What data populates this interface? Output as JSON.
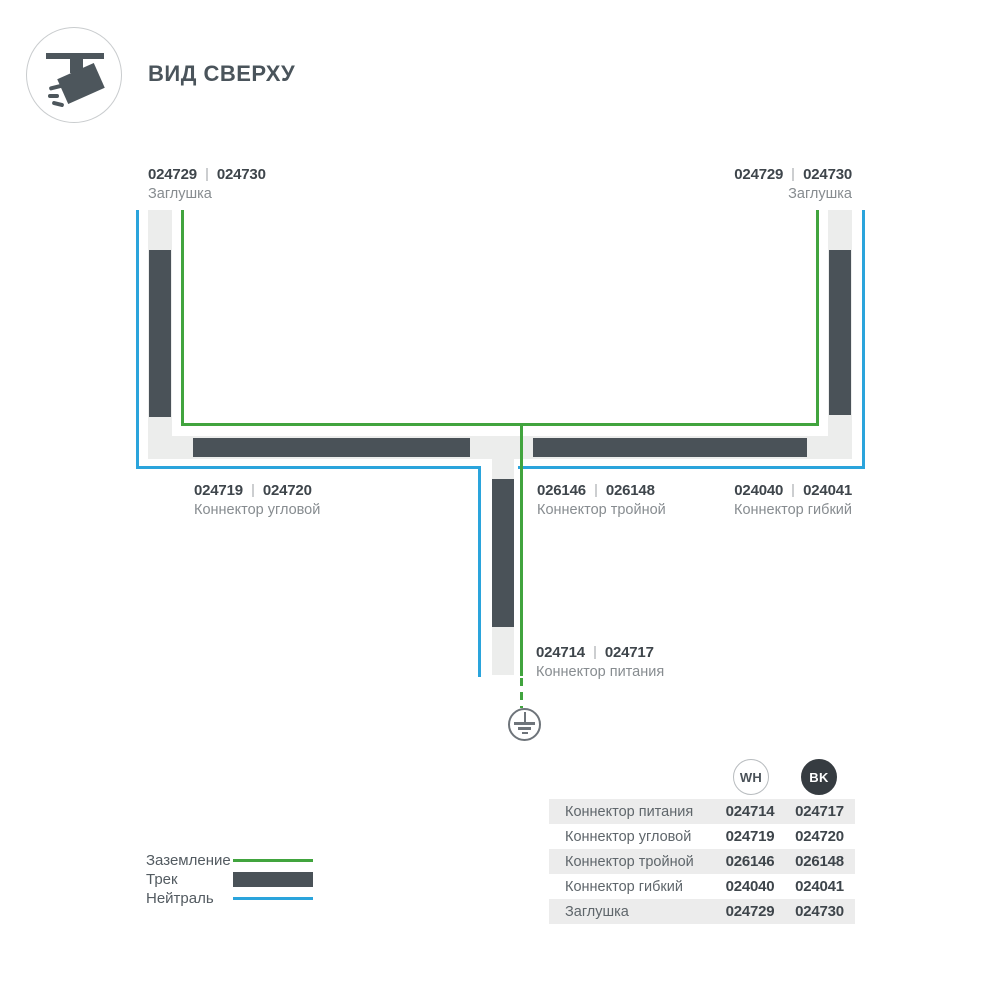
{
  "header": {
    "title": "ВИД СВЕРХУ",
    "icon": "track-spotlight-top-view"
  },
  "colors": {
    "track_bar": "#4a5258",
    "track_body": "#ecedec",
    "ground_line": "#41a43e",
    "neutral_line": "#2aa4dc",
    "bk_badge": "#363c41"
  },
  "labels": {
    "cap_left": {
      "code_wh": "024729",
      "code_bk": "024730",
      "name": "Заглушка"
    },
    "cap_right": {
      "code_wh": "024729",
      "code_bk": "024730",
      "name": "Заглушка"
    },
    "corner": {
      "code_wh": "024719",
      "code_bk": "024720",
      "name": "Коннектор угловой"
    },
    "tee": {
      "code_wh": "026146",
      "code_bk": "026148",
      "name": "Коннектор тройной"
    },
    "flex": {
      "code_wh": "024040",
      "code_bk": "024041",
      "name": "Коннектор гибкий"
    },
    "power": {
      "code_wh": "024714",
      "code_bk": "024717",
      "name": "Коннектор питания"
    }
  },
  "legend": {
    "ground": "Заземление",
    "track": "Трек",
    "neutral": "Нейтраль"
  },
  "table": {
    "columns": {
      "wh": "WH",
      "bk": "BK"
    },
    "rows": [
      {
        "name": "Коннектор питания",
        "wh": "024714",
        "bk": "024717"
      },
      {
        "name": "Коннектор угловой",
        "wh": "024719",
        "bk": "024720"
      },
      {
        "name": "Коннектор тройной",
        "wh": "026146",
        "bk": "026148"
      },
      {
        "name": "Коннектор гибкий",
        "wh": "024040",
        "bk": "024041"
      },
      {
        "name": "Заглушка",
        "wh": "024729",
        "bk": "024730"
      }
    ]
  }
}
